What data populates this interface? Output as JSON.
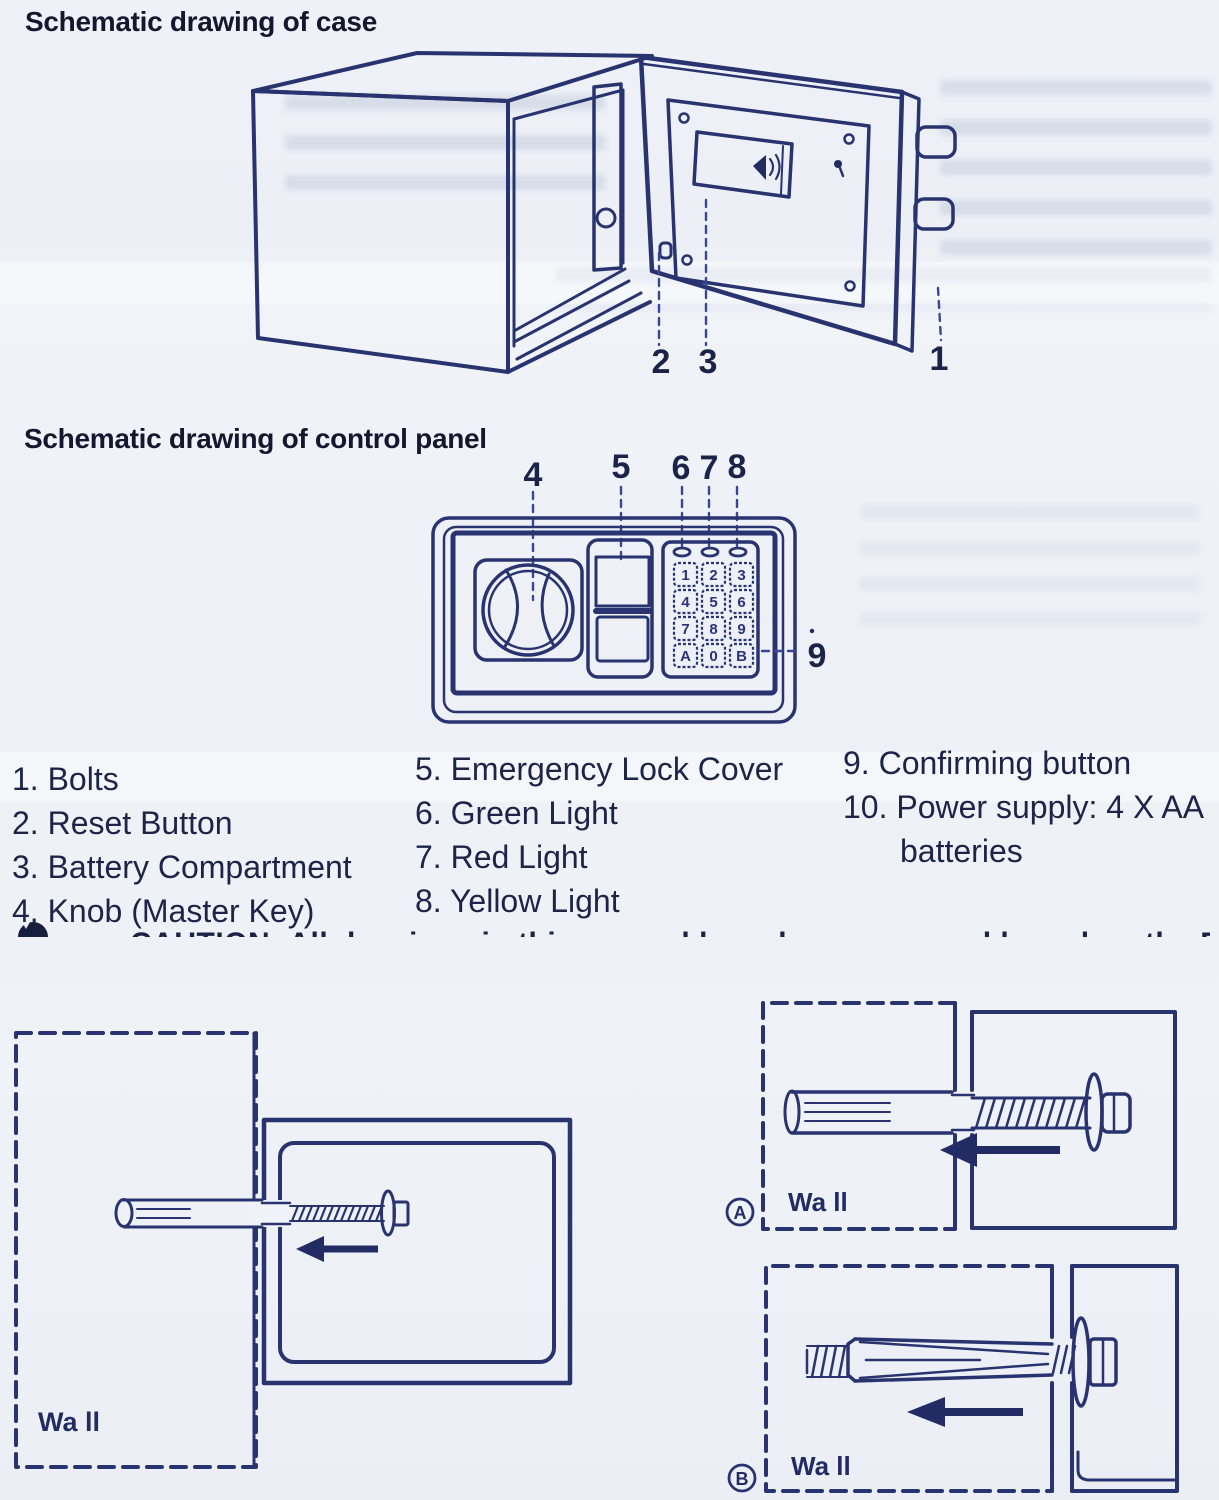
{
  "sections": {
    "case": {
      "heading": "Schematic drawing of case",
      "callouts": [
        "2",
        "3",
        "1"
      ]
    },
    "panel": {
      "heading": "Schematic drawing of control panel",
      "callouts": [
        "4",
        "5",
        "6",
        "7",
        "8",
        "9"
      ],
      "keypad_keys": [
        "1",
        "2",
        "3",
        "4",
        "5",
        "6",
        "7",
        "8",
        "9",
        "A",
        "0",
        "B"
      ]
    },
    "parts_list": {
      "column1": [
        "1. Bolts",
        "2. Reset Button",
        "3. Battery Compartment",
        "4. Knob (Master Key)"
      ],
      "column2": [
        "5. Emergency Lock Cover",
        "6. Green Light",
        "7. Red Light",
        "8. Yellow Light"
      ],
      "column3": [
        "9. Confirming button",
        "10. Power supply: 4 X AA",
        "batteries"
      ]
    },
    "caution": {
      "text_partial": "CAUTION: All drawings in this manual have been prepared based on the EA"
    },
    "mounting": {
      "wall_label": "Wa ll",
      "badges": [
        "A",
        "B"
      ]
    }
  },
  "colors": {
    "line_navy": "#29336f",
    "text_dark": "#1d2447",
    "paper": "#eef1f7"
  }
}
